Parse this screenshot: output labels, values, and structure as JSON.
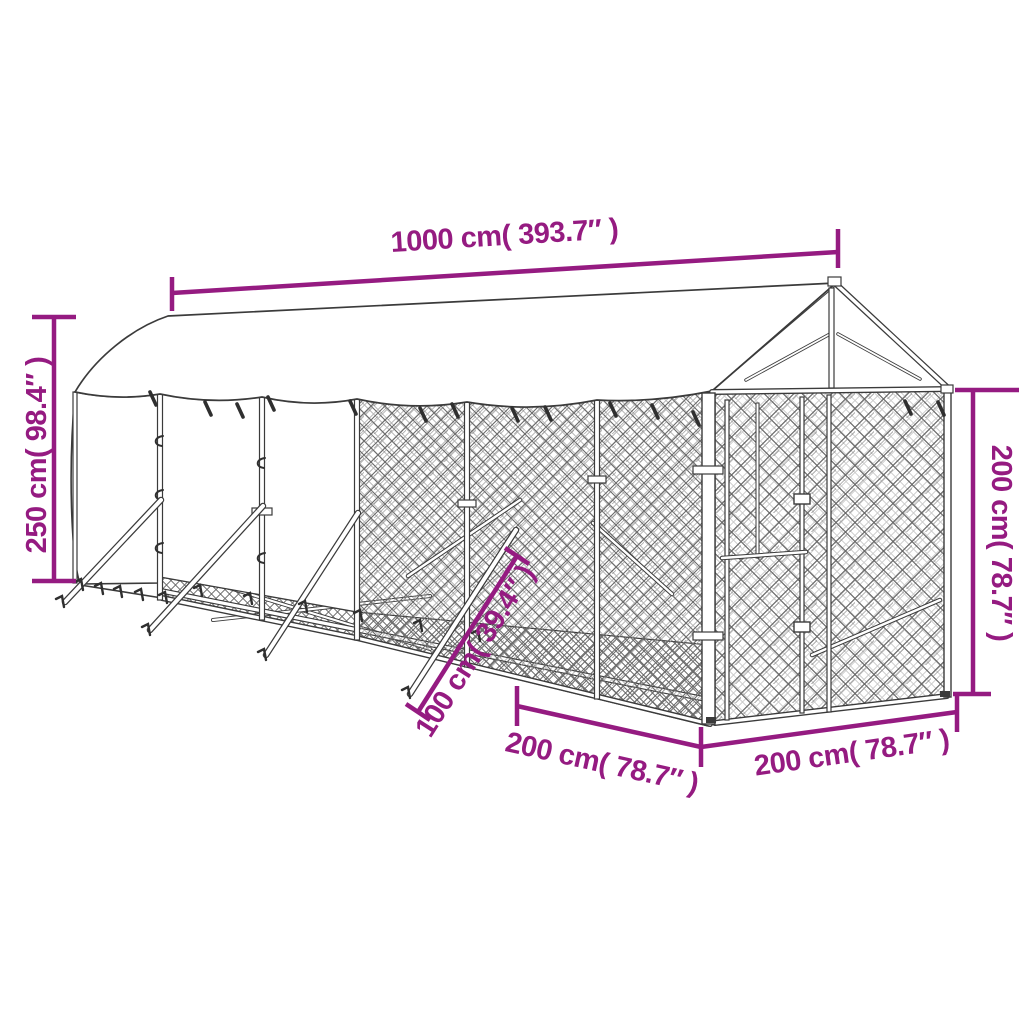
{
  "alt": "Outline product diagram of an outdoor dog kennel with roof: white tarp roof with gabled peak at right, two covered white side panels at left, chain-link mesh walls and door, ground braces, annotated with magenta dimension lines",
  "dimensions": {
    "top": "1000 cm( 393.7″ )",
    "left": "250 cm( 98.4″ )",
    "right": "200 cm( 78.7″ )",
    "bottom_front": "200 cm( 78.7″ )",
    "bottom_end": "200 cm( 78.7″ )",
    "brace": "100 cm( 39.4″ )"
  },
  "colors": {
    "dimension_accent": "#951b81",
    "line_art": "#3b3b3b",
    "mesh": "#6a6a6a",
    "background": "#ffffff"
  }
}
